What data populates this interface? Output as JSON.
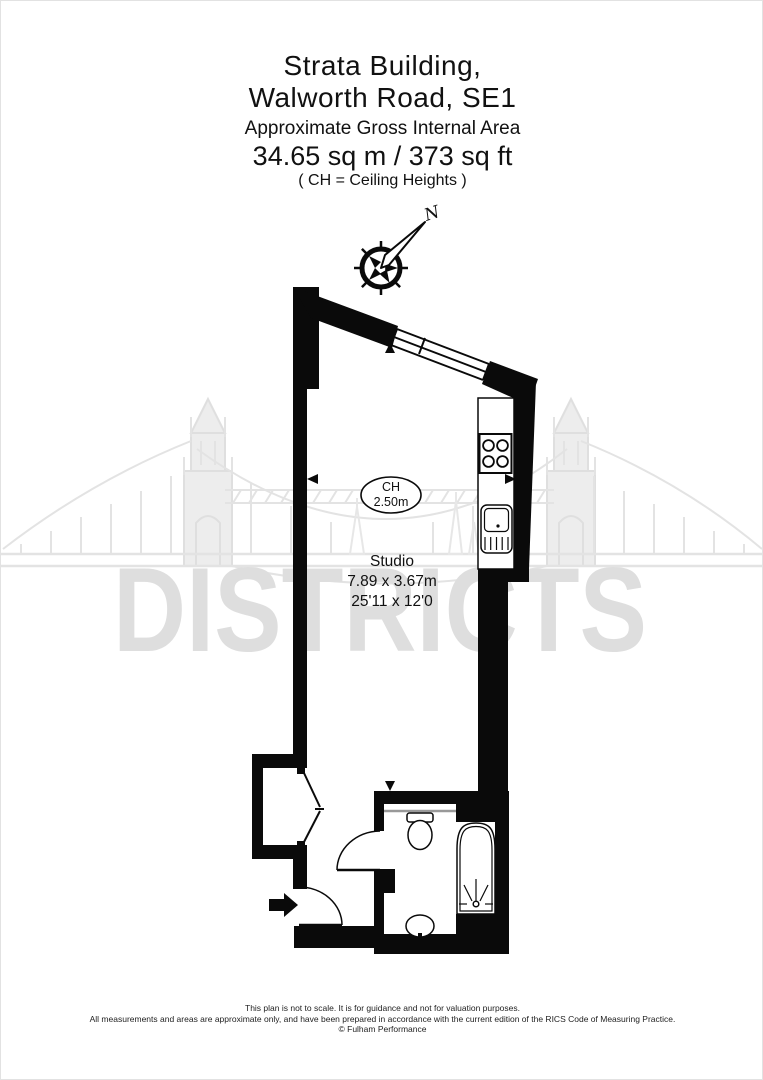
{
  "title": {
    "line1": "Strata Building,",
    "line2": "Walworth Road, SE1",
    "subtitle": "Approximate Gross Internal Area",
    "area": "34.65 sq m  /  373 sq ft",
    "note": "( CH = Ceiling Heights )"
  },
  "watermark": {
    "text": "DISTRICTS"
  },
  "compass": {
    "north_label": "N"
  },
  "rooms": {
    "studio": {
      "name": "Studio",
      "ceiling_label": "CH",
      "ceiling_height": "2.50m",
      "dimensions_metric": "7.89 x 3.67m",
      "dimensions_imperial": "25'11 x 12'0"
    }
  },
  "footer": {
    "line1": "This plan is not to scale. It is for guidance and not for valuation purposes.",
    "line2": "All measurements and areas are approximate only, and have been prepared in accordance with the current edition of the RICS Code of Measuring Practice.",
    "line3": "© Fulham Performance"
  },
  "colors": {
    "wall": "#0a0a0a",
    "watermark_text": "#dedede",
    "bridge_line": "#e3e3e3",
    "background": "#ffffff"
  }
}
